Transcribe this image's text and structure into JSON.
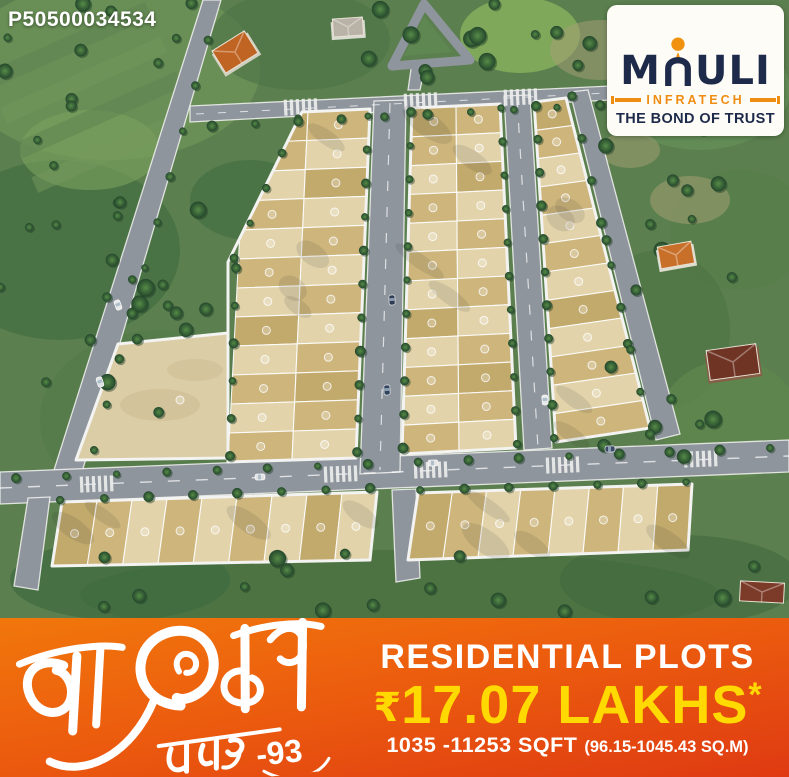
{
  "watermark_code": "P50500034534",
  "logo": {
    "brand": "MAULI",
    "brand_m": "M",
    "brand_uli": "ULI",
    "subtitle": "INFRATECH",
    "tagline": "THE BOND OF TRUST",
    "accent_orange": "#ef8d13",
    "navy": "#1e2a4a"
  },
  "banner": {
    "title_devanagari": "माऊली",
    "subtitle_devanagari": "नगर",
    "subtitle_suffix": "-93",
    "heading": "RESIDENTIAL PLOTS",
    "price_currency": "₹",
    "price_value": "17.07 LAKHS",
    "price_asterisk": "*",
    "area_sqft": "1035 -11253 SQFT",
    "area_sqm": "(96.15-1045.43 SQ.M)",
    "colors": {
      "top": "#f1770c",
      "bottom": "#df3a12",
      "price": "#ffd900",
      "text": "#ffffff"
    }
  },
  "site_plan": {
    "type": "aerial-3d-plot-layout-render",
    "blocks": [
      {
        "id": "west-block",
        "rows": 12,
        "columns": 2
      },
      {
        "id": "central-block",
        "rows": 12,
        "columns": 2
      },
      {
        "id": "east-block",
        "rows": 12,
        "columns": 1
      },
      {
        "id": "south-west-row",
        "rows": 1,
        "columns": 9
      },
      {
        "id": "south-east-row",
        "rows": 1,
        "columns": 8
      },
      {
        "id": "open-plot-area",
        "rows": 1,
        "columns": 1
      }
    ],
    "features": [
      "tree-lined internal roads",
      "numbered plot badges",
      "zebra crossings",
      "parked cars",
      "farm houses",
      "surrounding greenery"
    ],
    "colors": {
      "grass": "#5b7f4e",
      "grass_dark": "#3f6a40",
      "grass_light": "#79a05e",
      "road": "#8f959d",
      "curb": "#f3f3f1",
      "plot_light": "#e2d3ab",
      "plot_tan": "#cdb57c",
      "plot_gold": "#c2a96c",
      "open_area": "#dbcda6",
      "tree": "#2e5837"
    }
  }
}
